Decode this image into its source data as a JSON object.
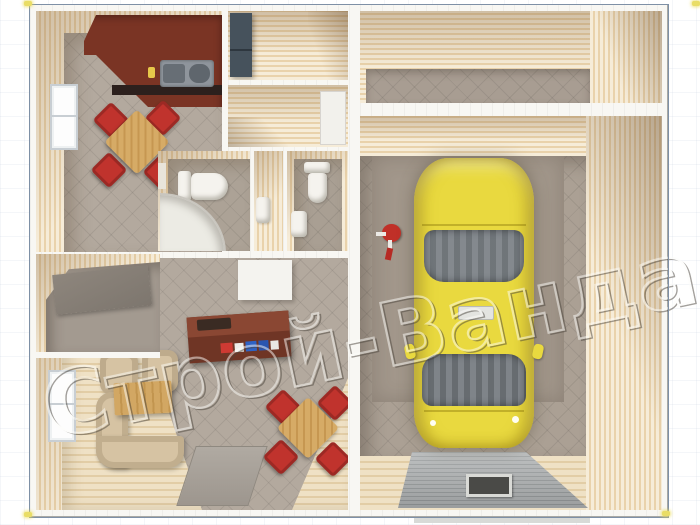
{
  "watermark": {
    "text": "Строй-Ванда"
  },
  "colors": {
    "frame": "#7e90a6",
    "handle": "#e9dd66",
    "counter": "#7a3424",
    "chair_red": "#c0332d",
    "wardrobe": "#46525c",
    "car_yellow": "#e9d93f",
    "car_glass": "#7c8287",
    "ramp": "#a3a6a7",
    "sofa": "#d6c3a3",
    "desk": "#6f3525",
    "tile": "#b3a99e"
  },
  "scene": {
    "type": "3d-floorplan-top-view",
    "sections": {
      "living_quarters": {
        "rooms": [
          "kitchen",
          "pantry",
          "hallway",
          "bathroom",
          "corridor",
          "wc",
          "utility-room",
          "living-room"
        ],
        "kitchen_items": [
          "kitchen-counter",
          "double-sink",
          "dining-table",
          "red-chairs",
          "window"
        ],
        "bathroom_items": [
          "toilet",
          "corner-shower"
        ],
        "wc_items": [
          "toilet",
          "washbasin"
        ],
        "living_items": [
          "computer-desk",
          "book-shelf-cabinet",
          "wall-cabinet",
          "corner-sofa",
          "armchairs",
          "coffee-table",
          "dining-table",
          "red-chairs",
          "rug",
          "window"
        ],
        "pantry_items": [
          "wardrobe-fridge"
        ]
      },
      "garage": {
        "rooms": [
          "storage-room",
          "garage-hall"
        ],
        "items": [
          "yellow-sedan-car",
          "mechanic-creeper",
          "ribbed-entrance-ramp",
          "floor-hatch"
        ]
      }
    }
  }
}
